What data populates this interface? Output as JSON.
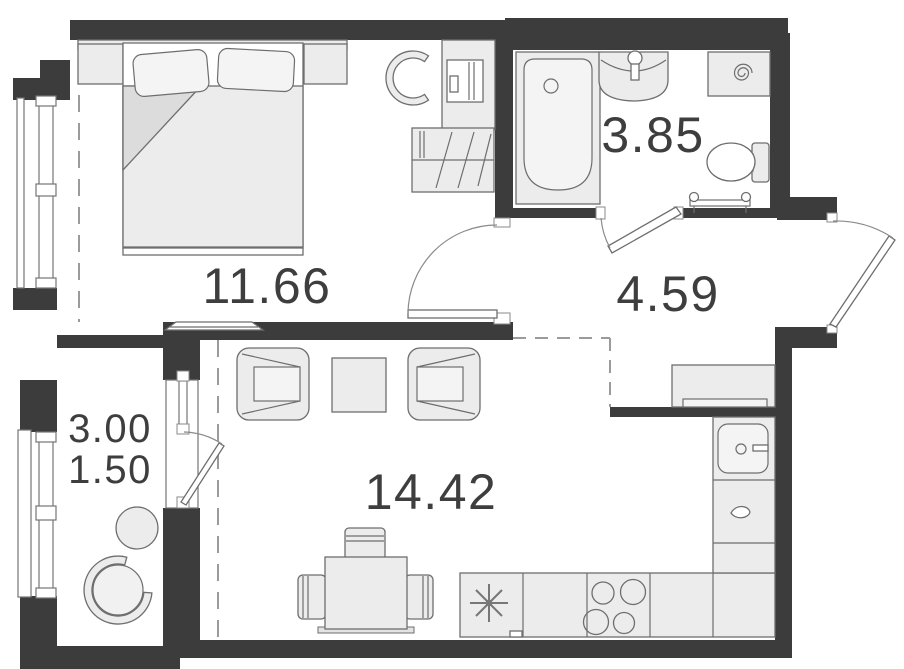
{
  "rooms": {
    "bedroom": {
      "area": "11.66"
    },
    "bathroom": {
      "area": "3.85"
    },
    "hallway": {
      "area": "4.59"
    },
    "living_kitchen": {
      "area": "14.42"
    },
    "balcony": {
      "area_total": "3.00",
      "area_reduced": "1.50"
    }
  },
  "colors": {
    "wall": "#3c3c3c",
    "furniture_fill": "#ececec",
    "furniture_stroke": "#6e6e6e",
    "dashed_line": "#9b9b9b",
    "label_text": "#3e3e3e",
    "background": "#ffffff"
  },
  "icons": {
    "bathroom": [
      "bathtub-icon",
      "sink-icon",
      "washing-machine-icon",
      "toilet-icon",
      "towel-rail-icon"
    ],
    "bedroom": [
      "double-bed-icon",
      "pillow-icon",
      "blanket-icon",
      "nightstand-icon",
      "desk-icon",
      "desk-chair-icon",
      "wardrobe-icon",
      "tv-console-icon",
      "window-icon"
    ],
    "living_kitchen": [
      "armchair-icon",
      "coffee-table-icon",
      "dining-table-icon",
      "dining-chair-icon",
      "fridge-icon",
      "hob-icon",
      "kitchen-sink-icon",
      "dishwasher-icon",
      "kitchen-counter-icon"
    ],
    "balcony": [
      "round-table-icon",
      "balcony-chair-icon",
      "window-icon"
    ],
    "doors": [
      "door-swing-icon"
    ]
  }
}
